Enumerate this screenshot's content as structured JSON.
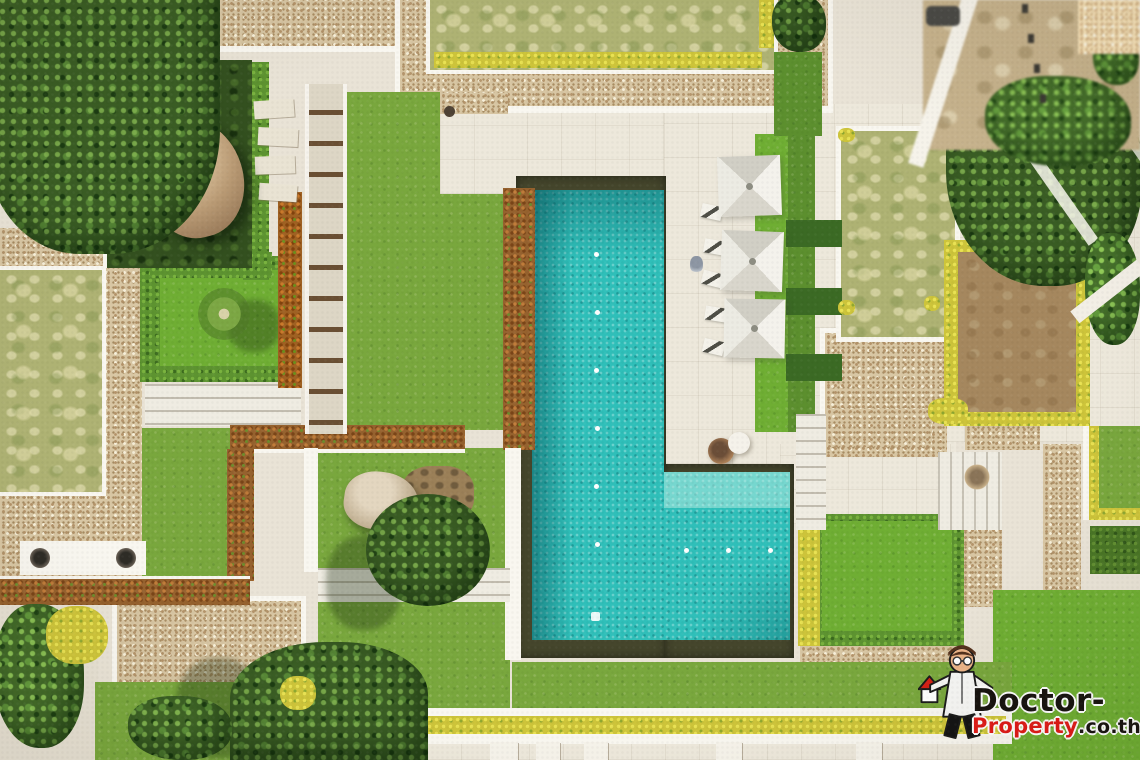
{
  "meta": {
    "type": "aerial-drone-photograph",
    "subject": "Top-down view of a modern tropical villa: L-shaped turquoise pool, white stone sun terrace with three square parasols and loungers, manicured lawns, grass green-roofs and pebble-gravel flat roofs, clipped rust and yellow hedges, boulder feature gardens and dense trees"
  },
  "watermark": {
    "line1": "Doctor-",
    "line2_brand": "Property",
    "line2_suffix": ".co.th",
    "line1_color": "#17130f",
    "brand_color": "#e01a17",
    "mascot_icon": "cartoon-doctor-holding-red-roof-house-and-stethoscope"
  },
  "palette": {
    "pool_water": "#2fbfb9",
    "pool_shallow_shelf": "#7fdcd4",
    "pool_gutter": "#45462c",
    "grass": "#79a73d",
    "pale_lawn": "#aeb273",
    "gravel_roof": "#d8c6a3",
    "stone_terrace": "#e9e3d6",
    "hedge_rust": "#96622e",
    "hedge_yellow": "#cdc43a",
    "tree_canopy": "#3a5d24"
  },
  "scene": {
    "pool_shape": "L-shaped",
    "umbrella_count": 3,
    "lounger_count": 5,
    "regions": [
      "dense-trees-top-left",
      "gravel-flat-roofs",
      "green-roof-lawns",
      "swimming-pool",
      "sun-terrace-with-parasols",
      "boulder-courtyard",
      "rust-hedge-borders",
      "stepping-stone-paths",
      "neighbouring-land-top-right"
    ]
  }
}
